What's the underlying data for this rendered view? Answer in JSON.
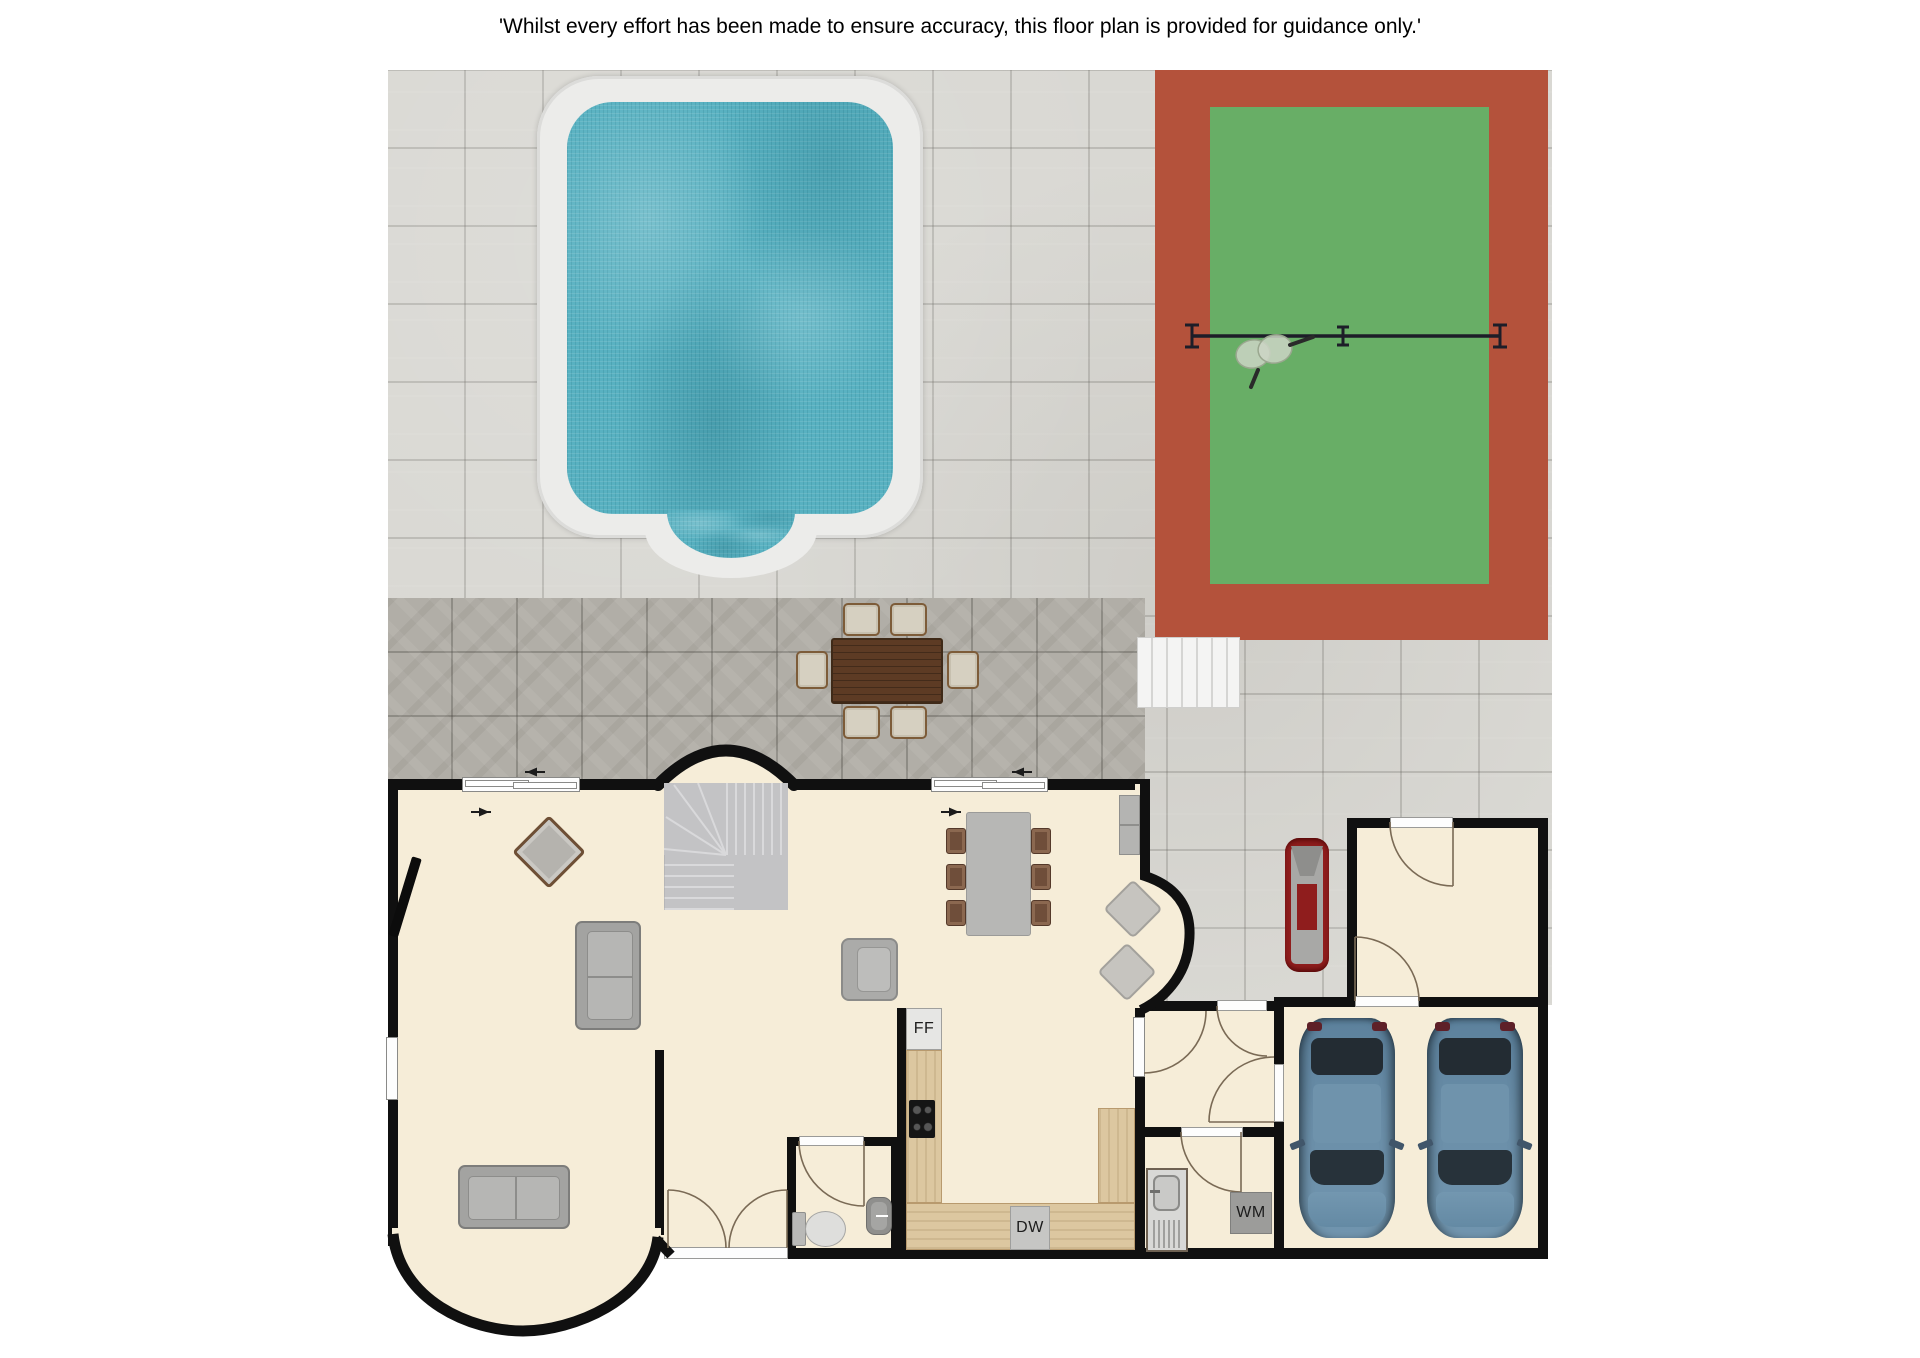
{
  "disclaimer": "'Whilst every effort has been made to ensure accuracy, this floor plan is provided for guidance only.'",
  "labels": {
    "fridge_freezer": "FF",
    "dishwasher": "DW",
    "washing_machine": "WM"
  },
  "colors": {
    "wall": "#101010",
    "floor": "#f6edd8",
    "patio_light": "#d9d8d3",
    "patio_dark": "#b1aea7",
    "tennis_border": "#b4523b",
    "tennis_court": "#68ae66",
    "pool_water": "#58b1c1",
    "pool_surround": "#ececea",
    "counter_wood": "#dcc7a0",
    "car_blue": "#64889f",
    "vehicle_red": "#8f1d1d"
  }
}
